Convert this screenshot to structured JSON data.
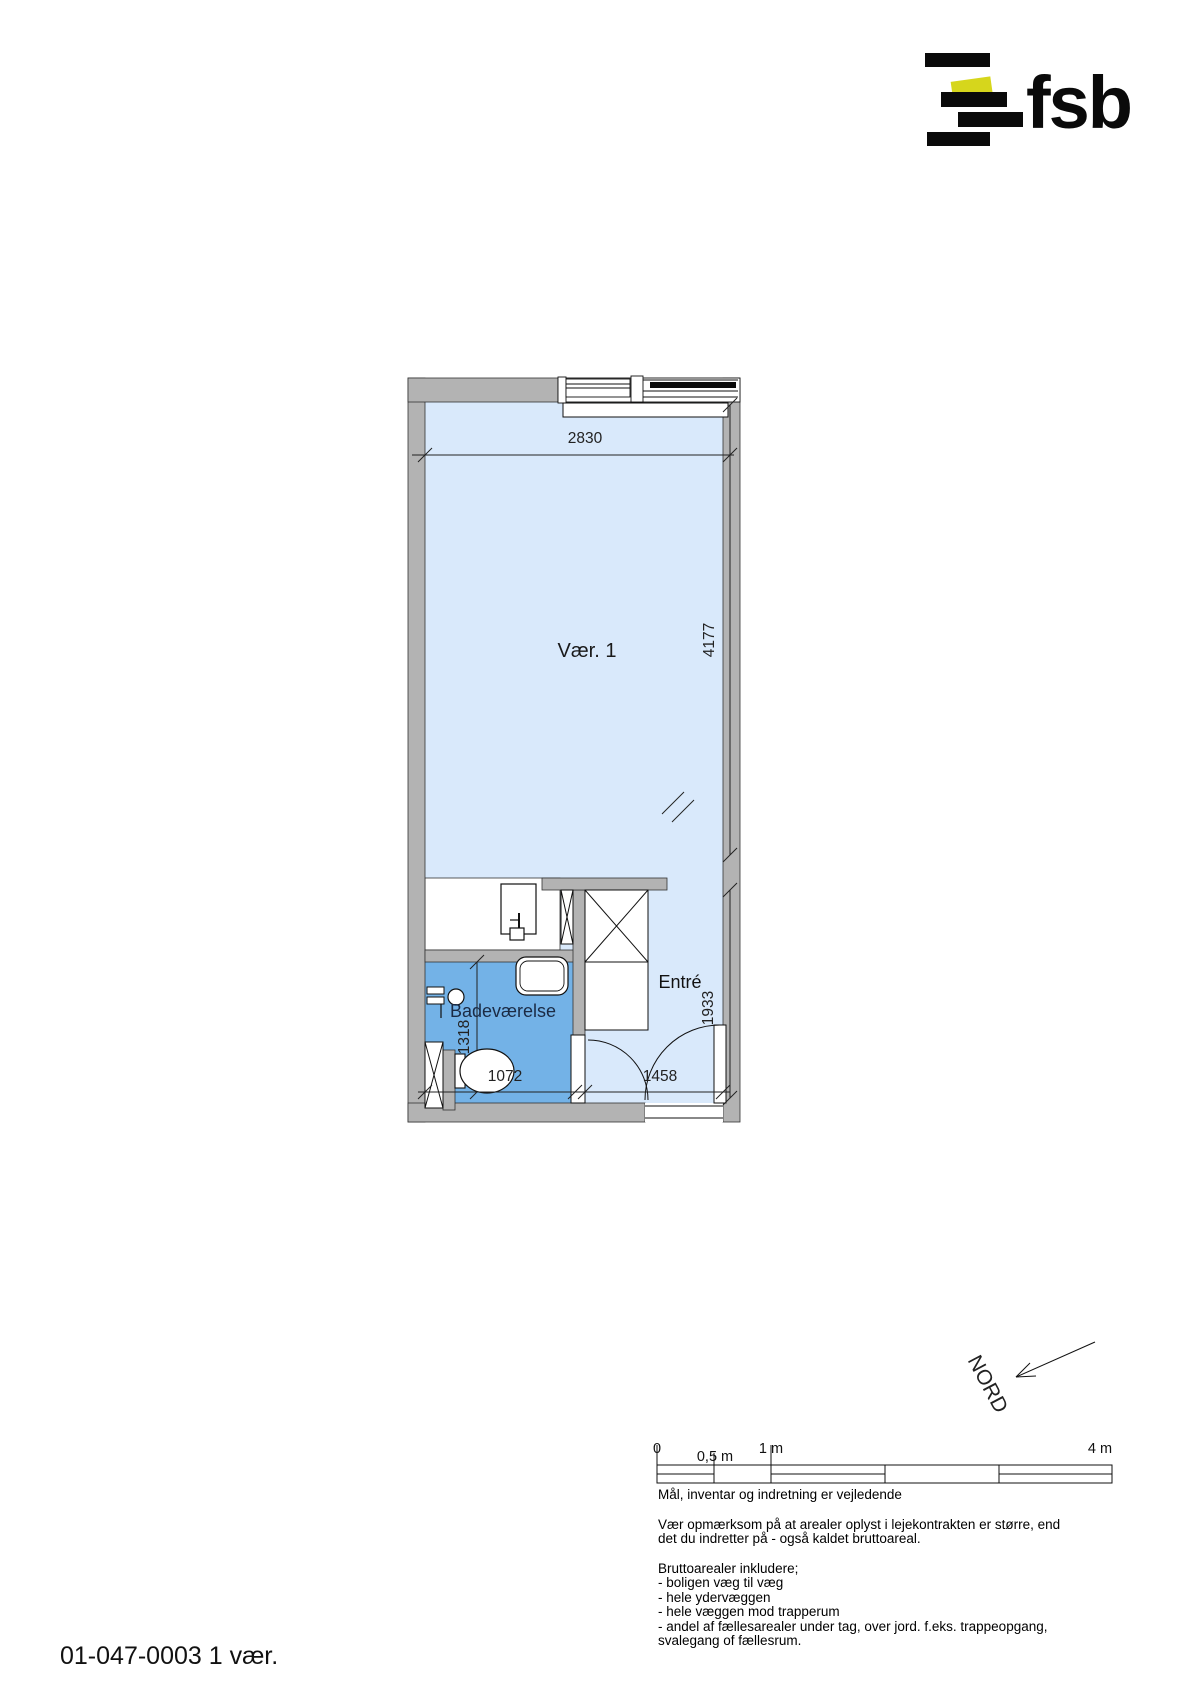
{
  "logo": {
    "text": "fsb"
  },
  "plan": {
    "rooms": {
      "vaer": "Vær. 1",
      "bad": "Badeværelse",
      "entre": "Entré"
    },
    "dims": {
      "top": "2830",
      "right": "4177",
      "entry": "1933",
      "bath_h": "1318",
      "bath_w": "1072",
      "entry_w": "1458"
    },
    "colors": {
      "room_fill": "#d9e9fb",
      "bathroom_fill": "#73b2e7",
      "wall_fill": "#b3b3b3",
      "logo_accent": "#d6d61c"
    }
  },
  "north": {
    "label": "NORD"
  },
  "scalebar": {
    "labels": [
      "0",
      "0,5 m",
      "1 m",
      "4 m"
    ]
  },
  "footer": {
    "guideline": "Mål, inventar og indretning er vejledende",
    "notice_line1": "Vær opmærksom på at arealer oplyst i lejekontrakten er større, end",
    "notice_line2": "det du indretter på - også kaldet bruttoareal.",
    "gross_area_lines": [
      "Bruttoarealer inkludere;",
      "- boligen væg til væg",
      "- hele ydervæggen",
      "- hele væggen mod trapperum",
      "- andel af fællesarealer under tag, over jord. f.eks. trappeopgang,",
      "svalegang of fællesrum."
    ]
  },
  "plan_id": {
    "text": "01-047-0003 1 vær."
  }
}
